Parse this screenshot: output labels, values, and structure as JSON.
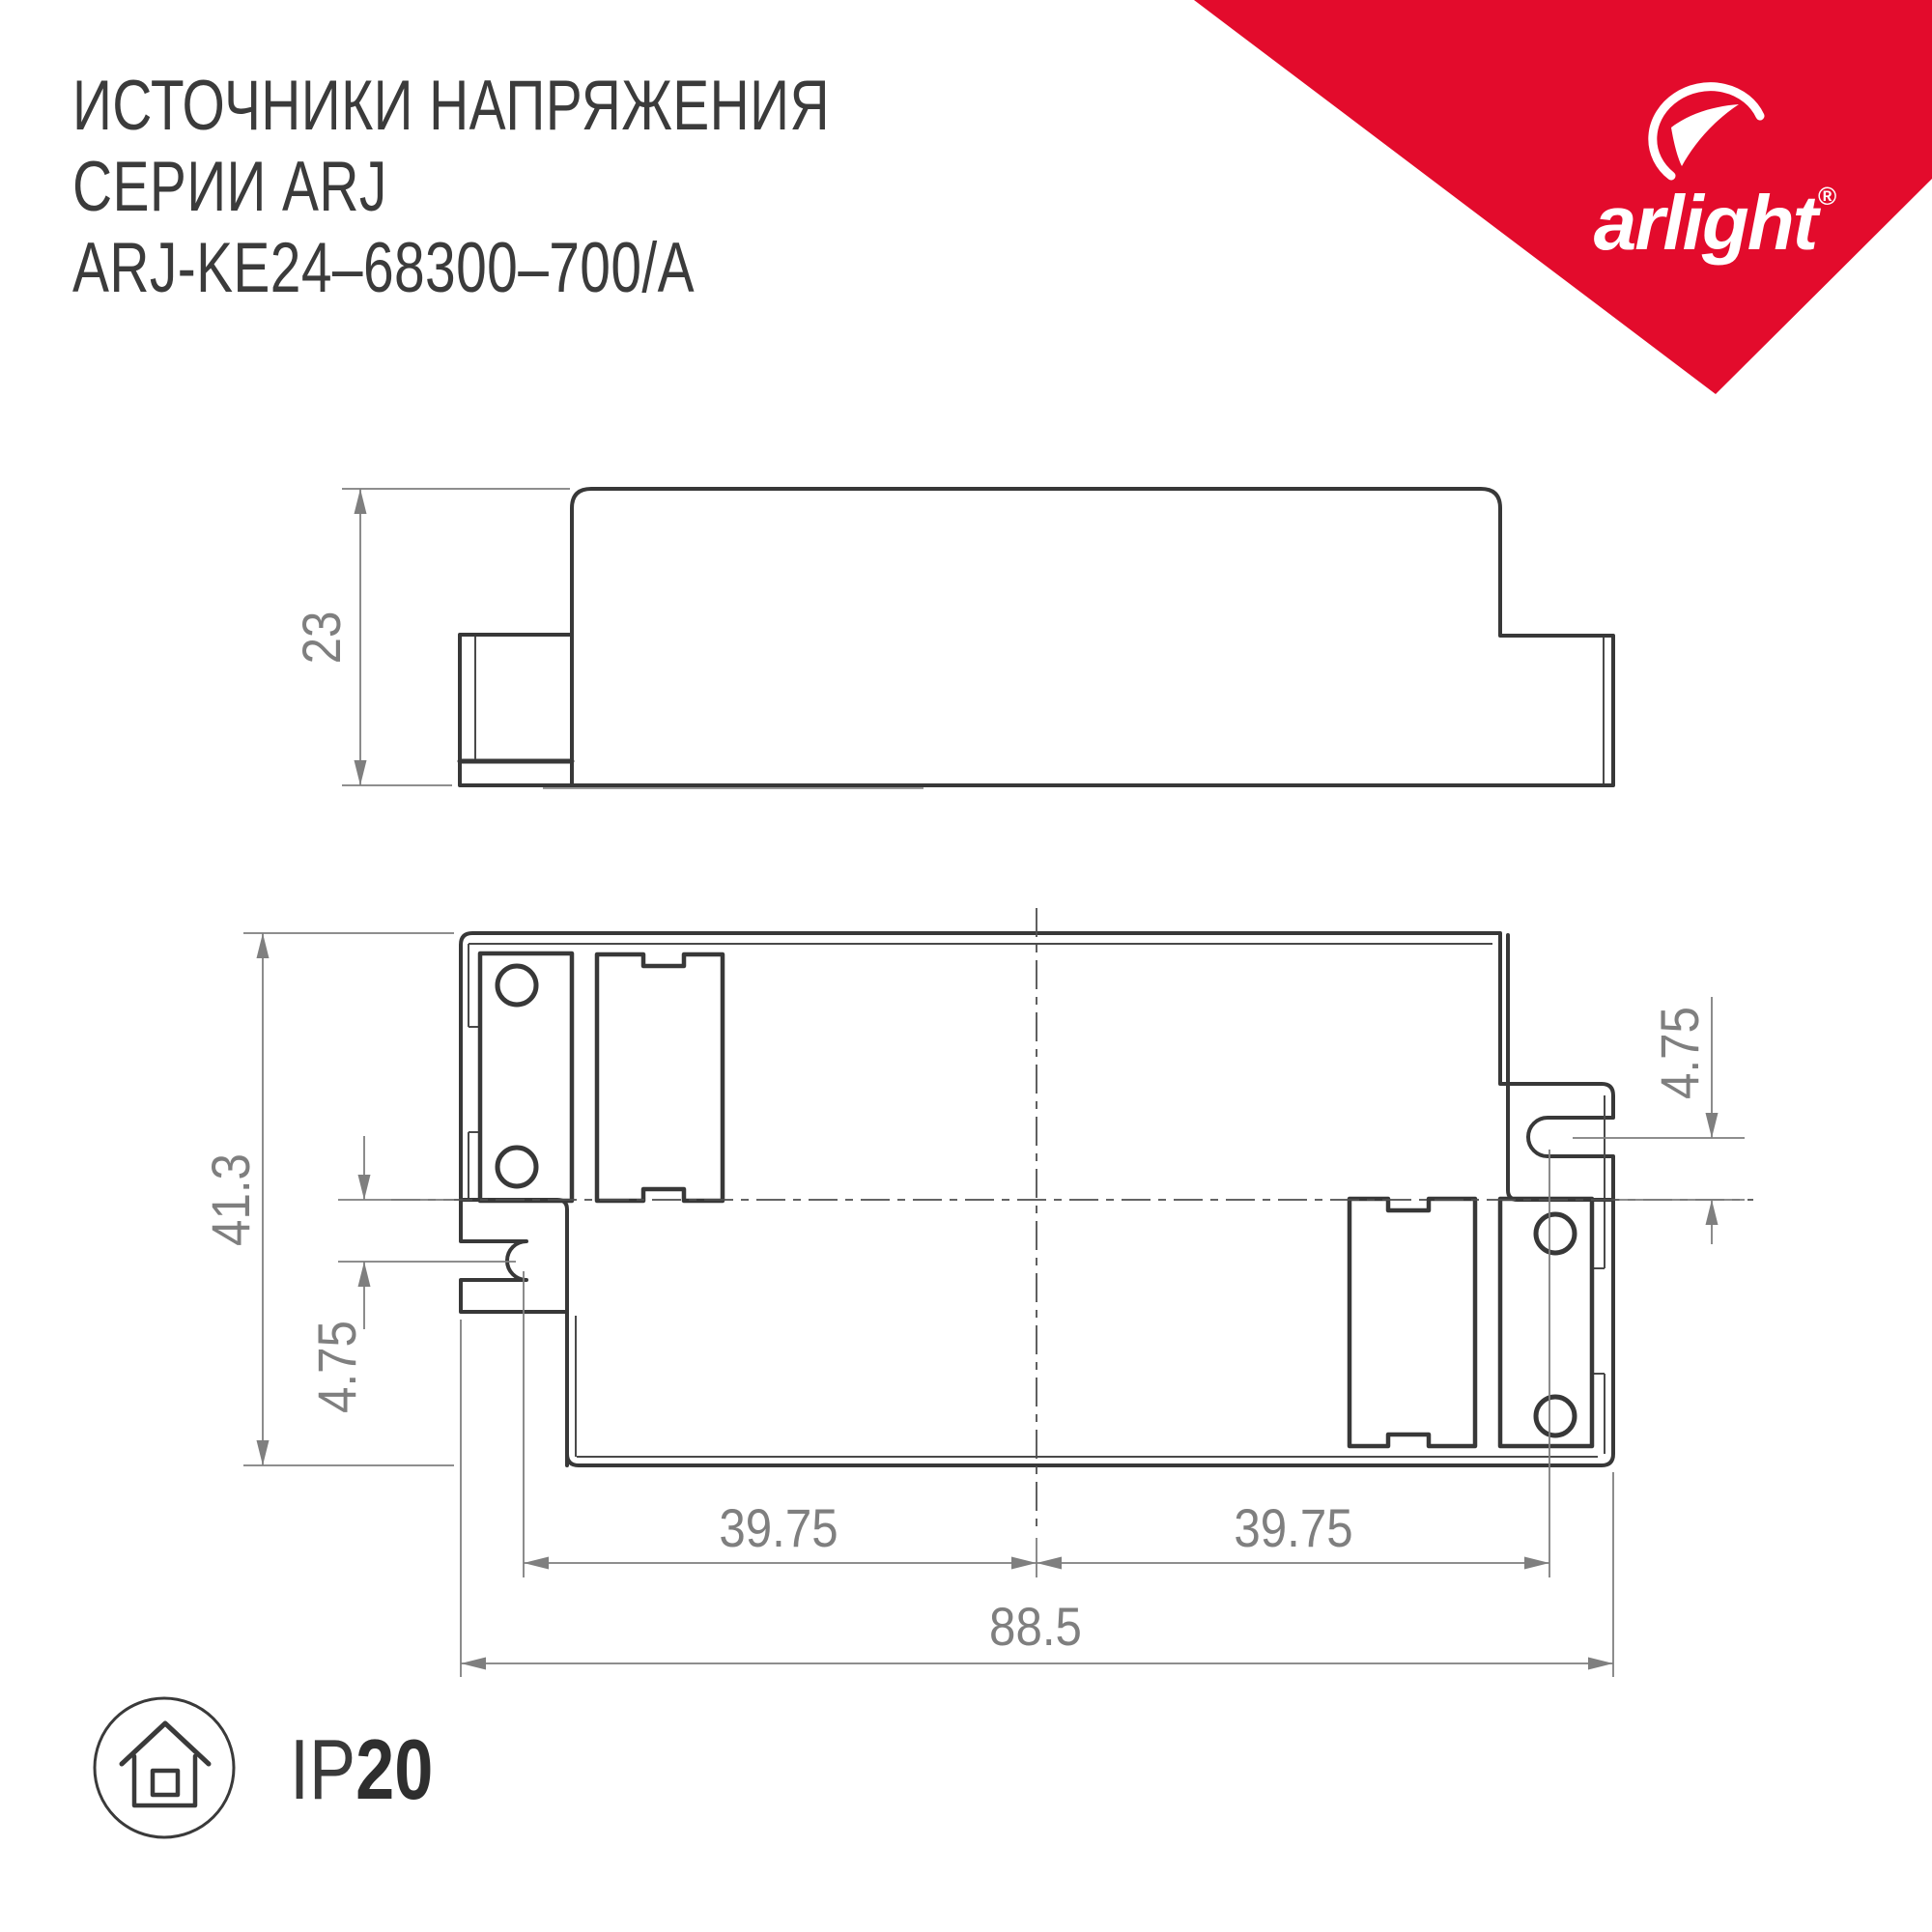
{
  "header": {
    "line1": "ИСТОЧНИКИ НАПРЯЖЕНИЯ",
    "line2": "СЕРИИ ARJ",
    "line3": "ARJ-KE24–68300–700/A"
  },
  "logo": {
    "brand": "arlight",
    "registered": "®",
    "color": "#e30b2c",
    "icon": "arlight-swoosh-icon"
  },
  "drawing": {
    "side_view": {
      "height": "23"
    },
    "top_view": {
      "height": "41.3",
      "slot_offset_left": "4.75",
      "slot_offset_right": "4.75",
      "hole_span_left": "39.75",
      "hole_span_right": "39.75",
      "total_width": "88.5"
    }
  },
  "ip_badge": {
    "prefix": "IP",
    "value": "20",
    "icon": "indoor-house-icon"
  }
}
